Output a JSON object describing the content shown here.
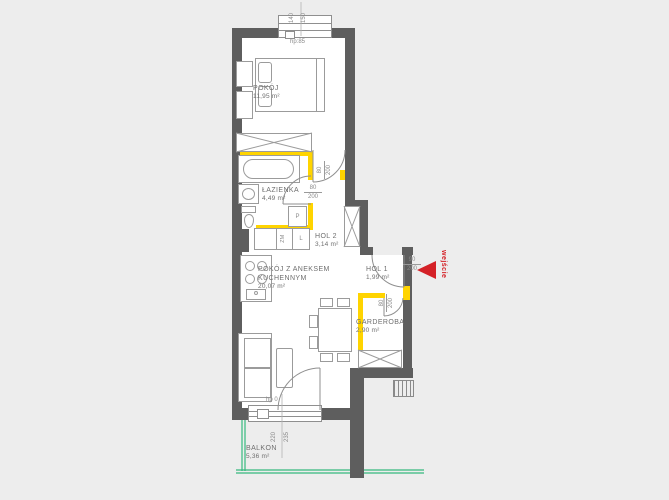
{
  "rooms": {
    "pokoj": {
      "name": "POKÓJ",
      "area": "11,95 m²"
    },
    "lazienka": {
      "name": "ŁAZIENKA",
      "area": "4,49 m²"
    },
    "hol2": {
      "name": "HOL 2",
      "area": "3,14 m²"
    },
    "salon": {
      "line1": "POKÓJ Z ANEKSEM",
      "line2": "KUCHENNYM",
      "area": "20,07 m²"
    },
    "hol1": {
      "name": "HOL 1",
      "area": "1,99 m²"
    },
    "garderoba": {
      "name": "GARDEROBA",
      "area": "2,90 m²"
    },
    "balkon": {
      "name": "BALKON",
      "area": "5,36 m²"
    }
  },
  "dims": {
    "top_window": {
      "w": "140",
      "h": "150",
      "sill": "hp:85"
    },
    "balcony_door": {
      "w": "220",
      "h": "235",
      "sill": "hp 0"
    },
    "bedroom_door": {
      "w": "80",
      "h": "200"
    },
    "bathroom_door": {
      "w": "80",
      "h": "200"
    },
    "entry_door": {
      "w": "90",
      "h": "200"
    },
    "garderoba_door": {
      "w": "80",
      "h": "200"
    }
  },
  "appliances": {
    "washing_machine": "P",
    "dishwasher": "ZM",
    "fridge": "L"
  },
  "entrance": {
    "label": "wejście"
  },
  "colors": {
    "wall": "#5e5e5e",
    "partition": "#ffd400",
    "balcony_line": "#35b97e",
    "entrance_red": "#d42127",
    "floor": "#ffffff",
    "background": "#ededed"
  }
}
